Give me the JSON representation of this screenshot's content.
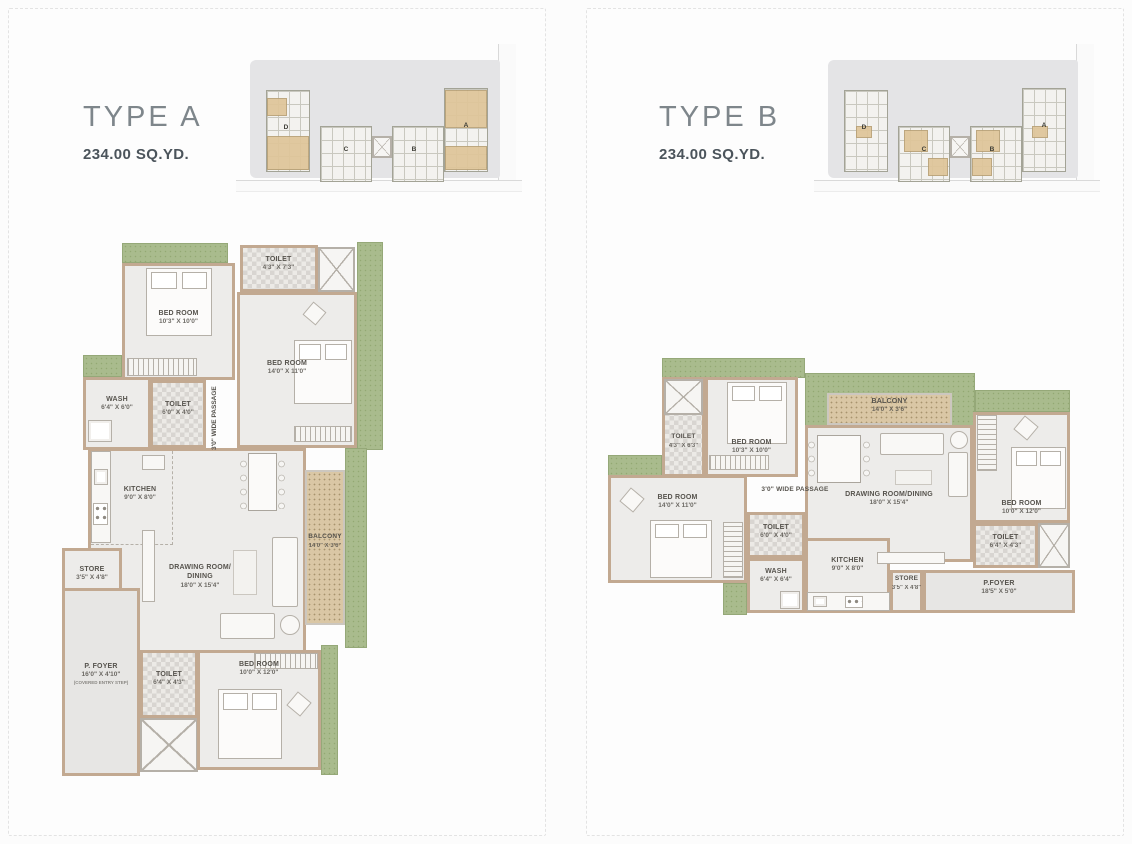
{
  "palette": {
    "wall": "#c2a991",
    "room": "#edecea",
    "green": "#a9bb8d",
    "deck": "#dac7a5",
    "foyer": "#e7e6e4",
    "checker_dark": "#d8d5d1",
    "checker_light": "#eceae6",
    "label": "#56534d",
    "title": "#7e868b",
    "area_text": "#4b545b",
    "keyplan_bg": "#e4e4e6",
    "highlight": "#dfc599",
    "panel_border": "#e3e3e3",
    "line": "#b5b0a8"
  },
  "typeA": {
    "title": "TYPE A",
    "area": "234.00 SQ.YD.",
    "keyplan": {
      "buildings": {
        "d": "D",
        "c": "C",
        "b": "B",
        "a": "A"
      }
    },
    "rooms": {
      "toiletTop": {
        "name": "TOILET",
        "dim": "4'3\" X 7'3\""
      },
      "bedroom1": {
        "name": "BED ROOM",
        "dim": "10'3\" X 10'0\""
      },
      "bedroom2": {
        "name": "BED ROOM",
        "dim": "14'0\" X 11'0\""
      },
      "wash": {
        "name": "WASH",
        "dim": "6'4\" X 6'0\""
      },
      "toiletMid": {
        "name": "TOILET",
        "dim": "6'0\" X 4'0\""
      },
      "passage": {
        "name": "3'0\" WIDE PASSAGE"
      },
      "kitchen": {
        "name": "KITCHEN",
        "dim": "9'0\" X 8'0\""
      },
      "store": {
        "name": "STORE",
        "dim": "3'5\" X 4'8\""
      },
      "drawing": {
        "name": "DRAWING ROOM/",
        "name2": "DINING",
        "dim": "18'0\" X 15'4\""
      },
      "balcony": {
        "name": "BALCONY",
        "dim": "14'0\" X 3'6\""
      },
      "pfoyer": {
        "name": "P. FOYER",
        "dim": "16'0\" X 4'10\"",
        "note": "(COVERED ENTRY STEP)"
      },
      "toiletBot": {
        "name": "TOILET",
        "dim": "6'4\" X 4'3\""
      },
      "bedroom3": {
        "name": "BED ROOM",
        "dim": "10'0\" X 12'0\""
      }
    }
  },
  "typeB": {
    "title": "TYPE B",
    "area": "234.00 SQ.YD.",
    "keyplan": {
      "buildings": {
        "d": "D",
        "c": "C",
        "b": "B",
        "a": "A"
      }
    },
    "rooms": {
      "toilet1": {
        "name": "TOILET",
        "dim": "4'3\" X 6'3\""
      },
      "bedroom1": {
        "name": "BED ROOM",
        "dim": "10'3\" X 10'0\""
      },
      "bedroom2": {
        "name": "BED ROOM",
        "dim": "14'0\" X 11'0\""
      },
      "balcony": {
        "name": "BALCONY",
        "dim": "14'0\" X 3'6\""
      },
      "drawing": {
        "name": "DRAWING ROOM/DINING",
        "dim": "18'0\" X 15'4\""
      },
      "passage": {
        "name": "3'0\" WIDE PASSAGE"
      },
      "toilet2": {
        "name": "TOILET",
        "dim": "6'0\" X 4'0\""
      },
      "wash": {
        "name": "WASH",
        "dim": "6'4\" X 6'4\""
      },
      "kitchen": {
        "name": "KITCHEN",
        "dim": "9'0\" X 8'0\""
      },
      "store": {
        "name": "STORE",
        "dim": "3'5\" X 4'8\""
      },
      "pfoyer": {
        "name": "P.FOYER",
        "dim": "18'5\" X 5'0\""
      },
      "bedroom3": {
        "name": "BED ROOM",
        "dim": "10'0\" X 12'0\""
      },
      "toilet3": {
        "name": "TOILET",
        "dim": "6'4\" X 4'3\""
      }
    }
  }
}
